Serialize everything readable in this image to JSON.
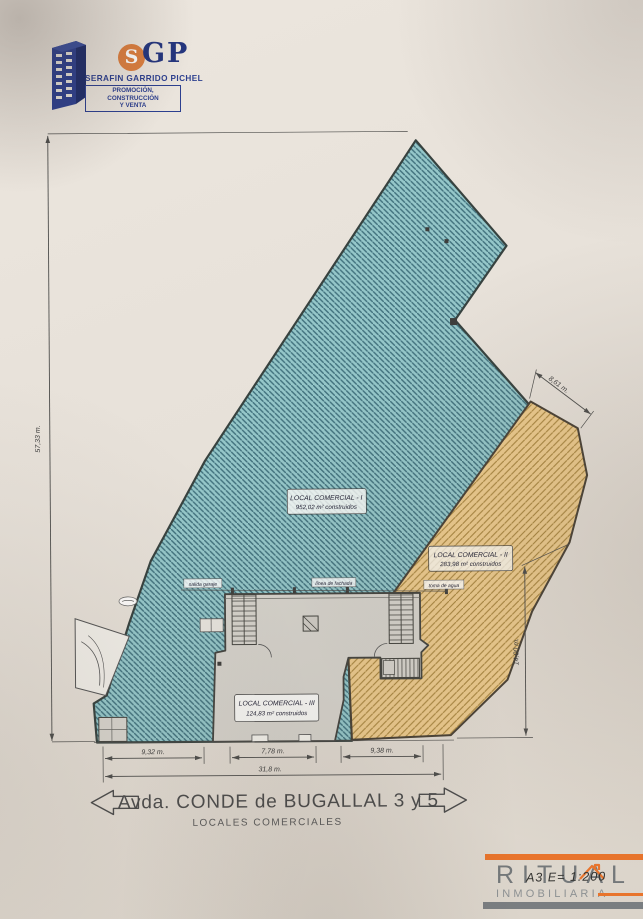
{
  "logo": {
    "monogram_s": "S",
    "monogram_gp": "GP",
    "company": "SERAFIN GARRIDO PICHEL",
    "tagline1": "PROMOCIÓN, CONSTRUCCIÓN",
    "tagline2": "Y VENTA"
  },
  "plan": {
    "units": [
      {
        "label": "LOCAL COMERCIAL - I",
        "area": "952,02 m² construidos",
        "fill": "#95c7c9"
      },
      {
        "label": "LOCAL COMERCIAL - II",
        "area": "283,98 m² construidos",
        "fill": "#ecca8d"
      },
      {
        "label": "LOCAL COMERCIAL - III",
        "area": "124,83 m² construidos",
        "fill": "#d6d3cc"
      }
    ],
    "annotations": [
      "salida garaje",
      "línea de fachada",
      "toma de agua"
    ],
    "dimensions": {
      "left": "57,33 m.",
      "top_right": "8,61 m.",
      "right": "14,00 m.",
      "bottom_1": "9,32 m.",
      "bottom_2": "7,78 m.",
      "bottom_3": "9,38 m.",
      "bottom_total": "31,8 m."
    }
  },
  "footer": {
    "street": "Avda. CONDE de BUGALLAL 3 y 5",
    "subtitle": "LOCALES COMERCIALES"
  },
  "watermark": {
    "brand": "RITUAL",
    "division": "INMOBILIARIA",
    "note": "A3   E= 1:200",
    "accent": "#e8742c"
  }
}
